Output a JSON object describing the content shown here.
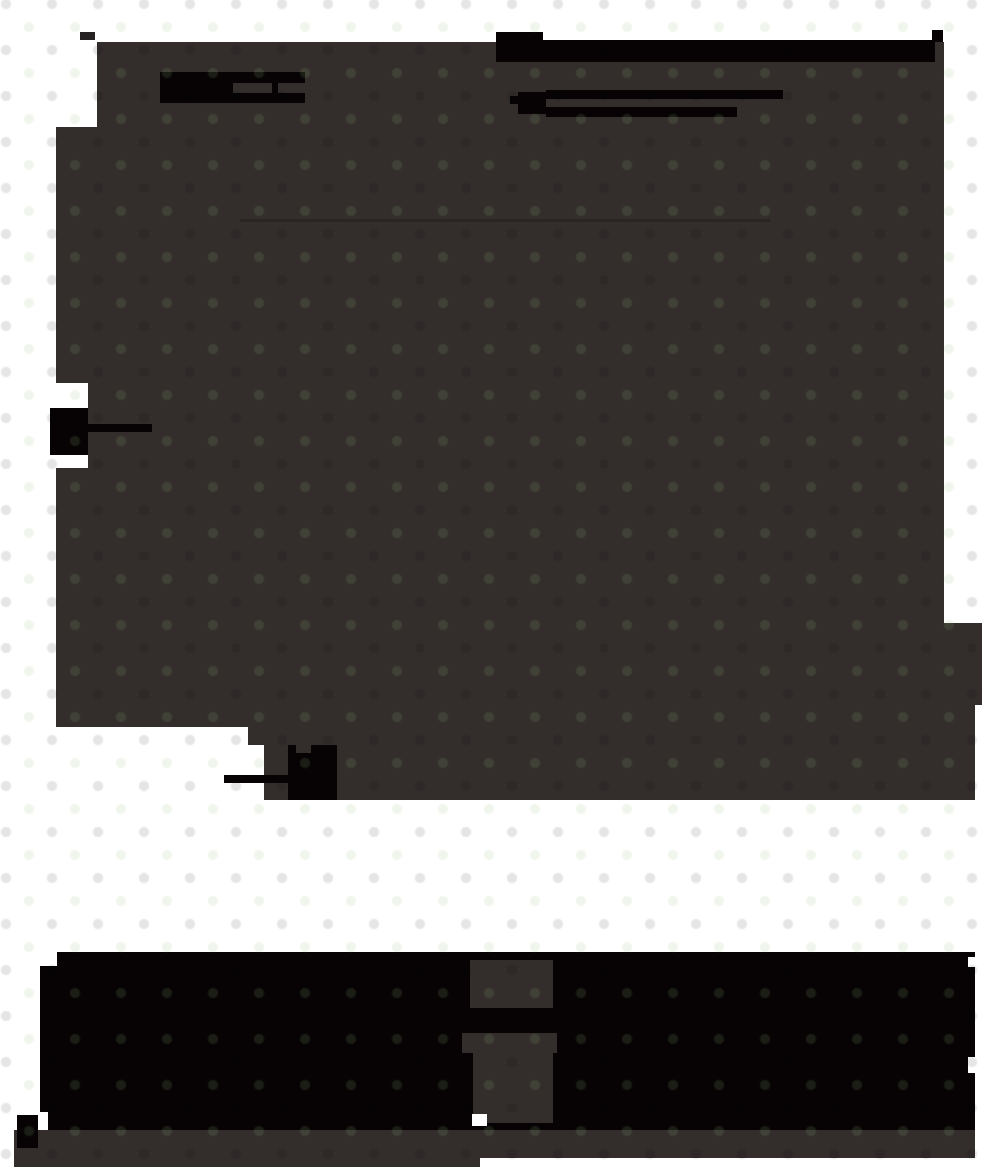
{
  "meta": {
    "description": "Very dark page render: large irregular dark-gray content mass over a white page, solid black redaction-style bars and markers, a white horizontal band, a wide black footer mass with gray cut-out pedestal shapes, and a gray base band.",
    "width": 982,
    "height": 1167
  },
  "palette": {
    "background": "#ffffff",
    "mass": "#332d2c",
    "ink": "#070304",
    "ink_soft": "#262122",
    "faint_line": "rgba(0,0,0,0.16)"
  },
  "shapes": [
    {
      "name": "content-mass-top",
      "x": 97,
      "y": 42,
      "w": 847,
      "h": 85,
      "fill": "mass"
    },
    {
      "name": "content-mass-mid",
      "x": 56,
      "y": 127,
      "w": 888,
      "h": 496,
      "fill": "mass"
    },
    {
      "name": "content-mass-right-bump",
      "x": 56,
      "y": 623,
      "w": 926,
      "h": 82,
      "fill": "mass"
    },
    {
      "name": "content-mass-bottom-left",
      "x": 56,
      "y": 705,
      "w": 192,
      "h": 22,
      "fill": "mass"
    },
    {
      "name": "content-mass-bottom-right",
      "x": 248,
      "y": 705,
      "w": 727,
      "h": 95,
      "fill": "mass"
    },
    {
      "name": "white-pocket-pin",
      "x": 40,
      "y": 383,
      "w": 48,
      "h": 85,
      "fill": "background"
    },
    {
      "name": "white-pocket-step",
      "x": 248,
      "y": 745,
      "w": 16,
      "h": 55,
      "fill": "background"
    },
    {
      "name": "corner-chip",
      "x": 80,
      "y": 32,
      "w": 15,
      "h": 8,
      "fill": "ink_soft"
    },
    {
      "name": "redaction-bar-a",
      "x": 160,
      "y": 72,
      "w": 145,
      "h": 31,
      "fill": "ink"
    },
    {
      "name": "redaction-bar-a-notch-1",
      "x": 233,
      "y": 83,
      "w": 39,
      "h": 10,
      "fill": "mass"
    },
    {
      "name": "redaction-bar-a-notch-2",
      "x": 278,
      "y": 83,
      "w": 27,
      "h": 10,
      "fill": "mass"
    },
    {
      "name": "headline-bar-block",
      "x": 496,
      "y": 32,
      "w": 47,
      "h": 30,
      "fill": "ink"
    },
    {
      "name": "headline-bar-long",
      "x": 543,
      "y": 40,
      "w": 392,
      "h": 22,
      "fill": "ink"
    },
    {
      "name": "headline-bar-tick",
      "x": 932,
      "y": 30,
      "w": 11,
      "h": 12,
      "fill": "ink"
    },
    {
      "name": "subhead-nub",
      "x": 510,
      "y": 96,
      "w": 8,
      "h": 8,
      "fill": "ink"
    },
    {
      "name": "subhead-block",
      "x": 518,
      "y": 92,
      "w": 28,
      "h": 22,
      "fill": "ink"
    },
    {
      "name": "subhead-line-1",
      "x": 546,
      "y": 90,
      "w": 237,
      "h": 9,
      "fill": "ink"
    },
    {
      "name": "subhead-line-2",
      "x": 546,
      "y": 107,
      "w": 191,
      "h": 10,
      "fill": "ink"
    },
    {
      "name": "faint-rule",
      "x": 240,
      "y": 219,
      "w": 530,
      "h": 3,
      "fill": "faint_line"
    },
    {
      "name": "pin-marker",
      "x": 50,
      "y": 408,
      "w": 38,
      "h": 47,
      "fill": "ink"
    },
    {
      "name": "pin-marker-line",
      "x": 80,
      "y": 424,
      "w": 72,
      "h": 8,
      "fill": "ink"
    },
    {
      "name": "blob-marker",
      "x": 288,
      "y": 745,
      "w": 49,
      "h": 55,
      "fill": "ink"
    },
    {
      "name": "blob-marker-notch",
      "x": 296,
      "y": 745,
      "w": 15,
      "h": 8,
      "fill": "mass"
    },
    {
      "name": "blob-marker-line",
      "x": 224,
      "y": 775,
      "w": 64,
      "h": 8,
      "fill": "ink"
    },
    {
      "name": "footer-mass-top-strip",
      "x": 57,
      "y": 952,
      "w": 918,
      "h": 14,
      "fill": "ink"
    },
    {
      "name": "footer-mass-main",
      "x": 40,
      "y": 966,
      "w": 935,
      "h": 164,
      "fill": "ink"
    },
    {
      "name": "footer-mass-ledge",
      "x": 225,
      "y": 1130,
      "w": 266,
      "h": 8,
      "fill": "ink"
    },
    {
      "name": "footer-cutout-upper",
      "x": 470,
      "y": 960,
      "w": 83,
      "h": 48,
      "fill": "mass"
    },
    {
      "name": "footer-cutout-cap",
      "x": 462,
      "y": 1033,
      "w": 95,
      "h": 20,
      "fill": "mass"
    },
    {
      "name": "footer-cutout-column",
      "x": 473,
      "y": 1053,
      "w": 80,
      "h": 70,
      "fill": "mass"
    },
    {
      "name": "footer-white-speck",
      "x": 472,
      "y": 1114,
      "w": 15,
      "h": 12,
      "fill": "background"
    },
    {
      "name": "footer-notch-right-1",
      "x": 968,
      "y": 957,
      "w": 14,
      "h": 10,
      "fill": "background"
    },
    {
      "name": "footer-notch-right-2",
      "x": 968,
      "y": 1057,
      "w": 14,
      "h": 16,
      "fill": "background"
    },
    {
      "name": "footer-white-pocket-left",
      "x": 40,
      "y": 1112,
      "w": 8,
      "h": 18,
      "fill": "background"
    },
    {
      "name": "base-band",
      "x": 14,
      "y": 1130,
      "w": 961,
      "h": 28,
      "fill": "mass"
    },
    {
      "name": "base-band-left-extension",
      "x": 14,
      "y": 1155,
      "w": 466,
      "h": 12,
      "fill": "mass"
    },
    {
      "name": "base-tab",
      "x": 17,
      "y": 1115,
      "w": 21,
      "h": 33,
      "fill": "ink"
    }
  ]
}
